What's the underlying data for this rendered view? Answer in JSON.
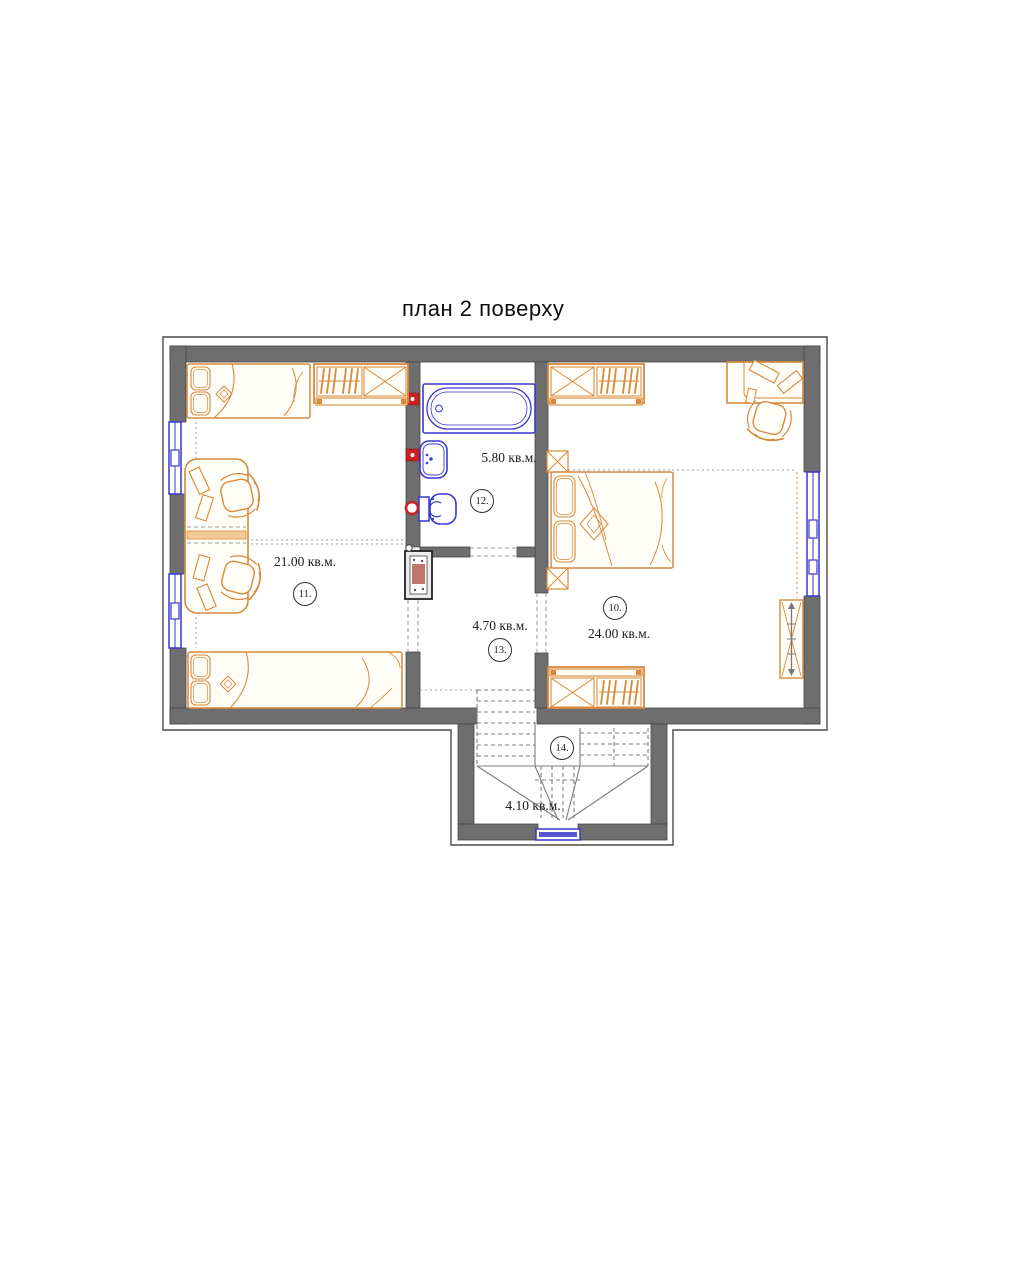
{
  "title": "план 2 поверху",
  "colors": {
    "wall": "#6e6e6e",
    "wall_stroke": "#474747",
    "frame": "#4a4a4a",
    "furniture": "#d8893b",
    "furniture_fill": "#fffdf7",
    "furniture_band": "#f2cb96",
    "fixture": "#3937cf",
    "accent_red": "#cc2020",
    "dash": "#9b9b9b",
    "stair": "#7d7d7d",
    "shaft_core": "#b8685c"
  },
  "rooms": {
    "r10": {
      "number": "10.",
      "area": "24.00 кв.м."
    },
    "r11": {
      "number": "11.",
      "area": "21.00 кв.м."
    },
    "r12": {
      "number": "12.",
      "area": "5.80 кв.м."
    },
    "r13": {
      "number": "13.",
      "area": "4.70 кв.м."
    },
    "r14": {
      "number": "14.",
      "area": "4.10 кв.м."
    }
  }
}
